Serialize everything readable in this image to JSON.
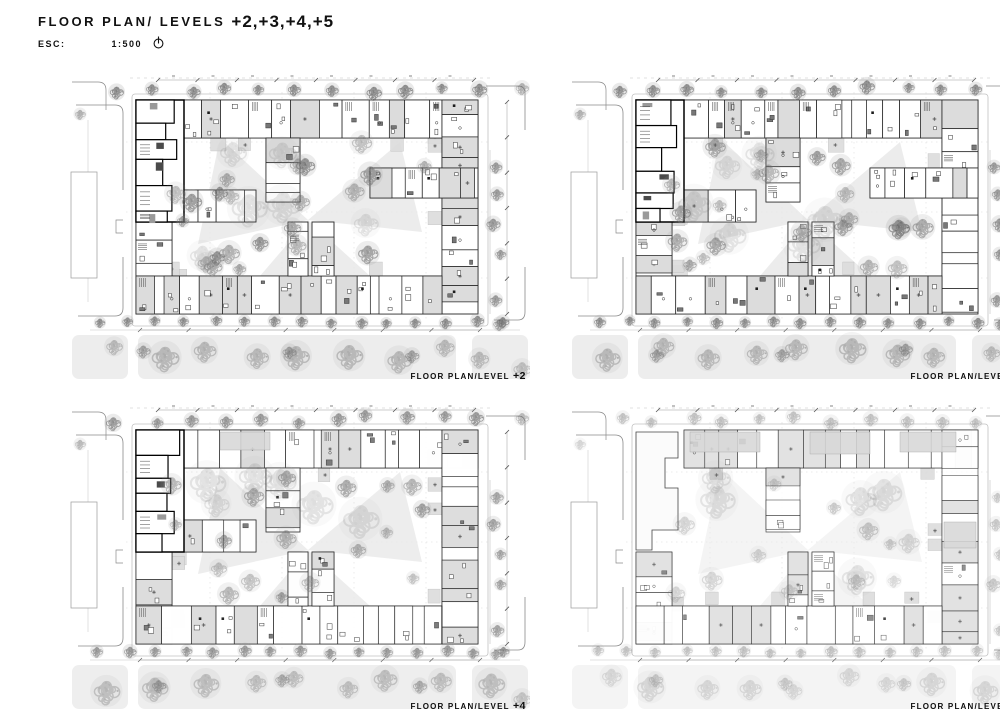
{
  "header": {
    "title_prefix": "FLOOR PLAN/ LEVELS",
    "title_levels": "+2,+3,+4,+5",
    "scale_label": "ESC:",
    "scale_value": "1:500"
  },
  "plans": [
    {
      "id": "level-plus-2",
      "caption_prefix": "FLOOR PLAN/LEVEL",
      "level_label": "+2"
    },
    {
      "id": "level-plus-3",
      "caption_prefix": "FLOOR PLAN/LEVEL",
      "level_label": "+3"
    },
    {
      "id": "level-plus-4",
      "caption_prefix": "FLOOR PLAN/LEVEL",
      "level_label": "+4"
    },
    {
      "id": "level-plus-5",
      "caption_prefix": "FLOOR PLAN/LEVEL",
      "level_label": "+5"
    }
  ],
  "colors": {
    "ink": "#111111",
    "wall_line": "#252525",
    "heavy_wall": "#000000",
    "kerb_line": "#8a8a8a",
    "light_line": "#c2c2c2",
    "unit_gray": "#dcdcdc",
    "landscape_band": "#ededed",
    "tree_stroke": "#767676",
    "paper": "#ffffff"
  }
}
